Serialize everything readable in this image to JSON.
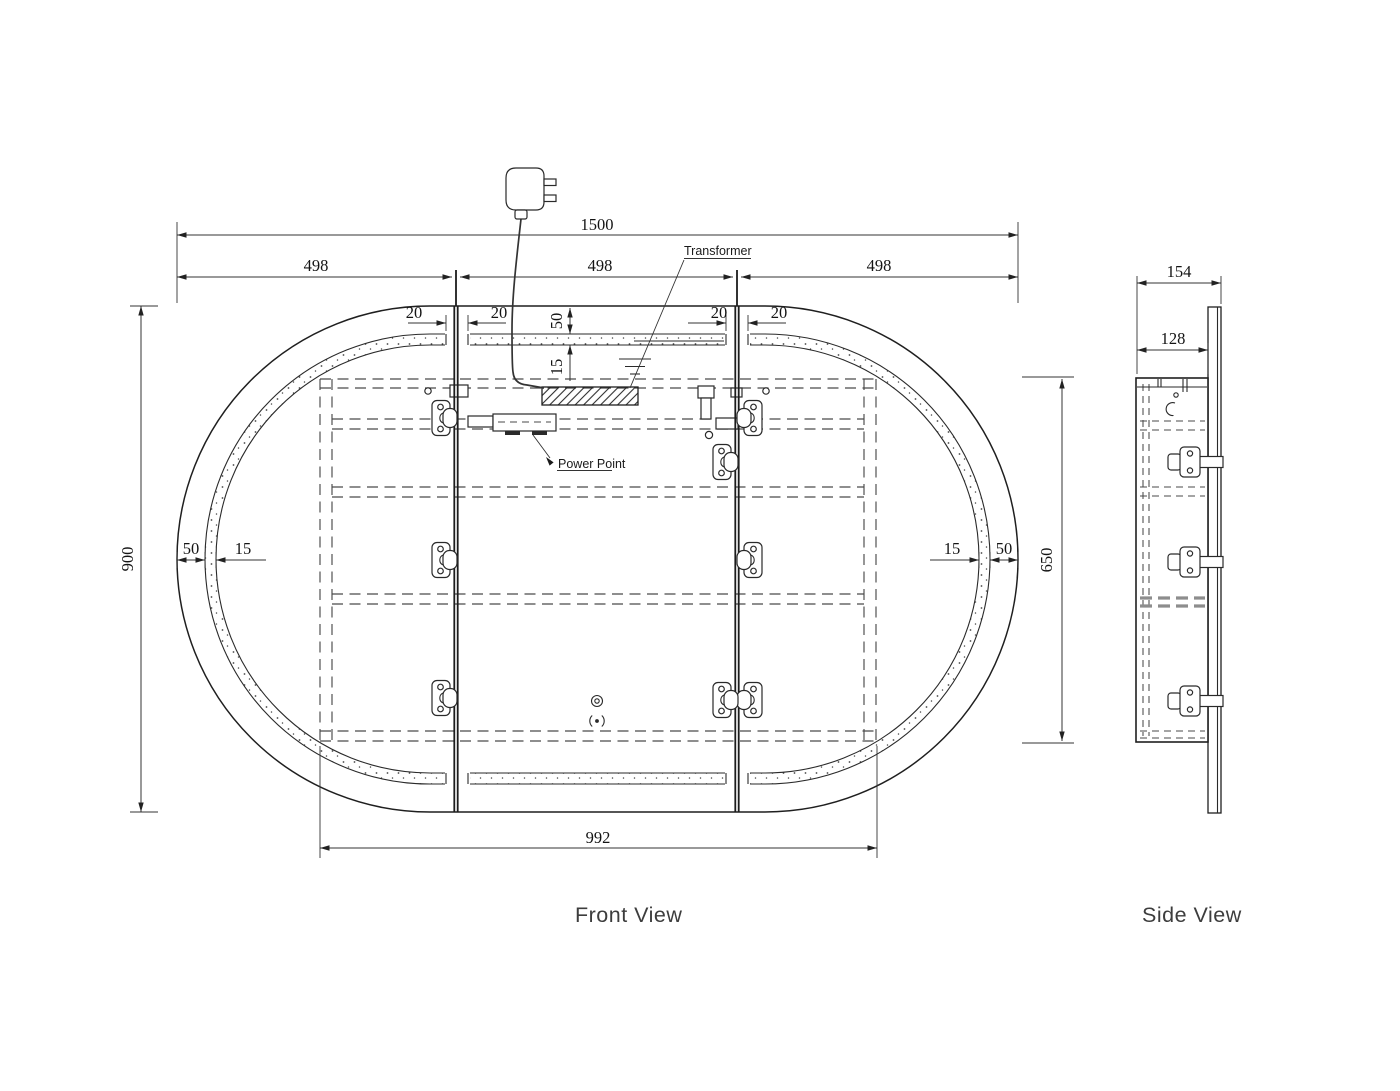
{
  "colors": {
    "ink": "#2a2a2a",
    "highlight_shelf": "#8d8d8d",
    "background": "#ffffff"
  },
  "front_view": {
    "label": "Front View",
    "dimensions": {
      "overall_width": "1500",
      "door_width": "498",
      "door_gap": "20",
      "frame_offset": "50",
      "led_strip_width": "15",
      "overall_height": "900",
      "cabinet_width": "992",
      "cabinet_height": "650"
    },
    "annotations": {
      "transformer": "Transformer",
      "power_point": "Power Point"
    }
  },
  "side_view": {
    "label": "Side View",
    "dimensions": {
      "overall_depth": "154",
      "cabinet_depth": "128"
    }
  }
}
